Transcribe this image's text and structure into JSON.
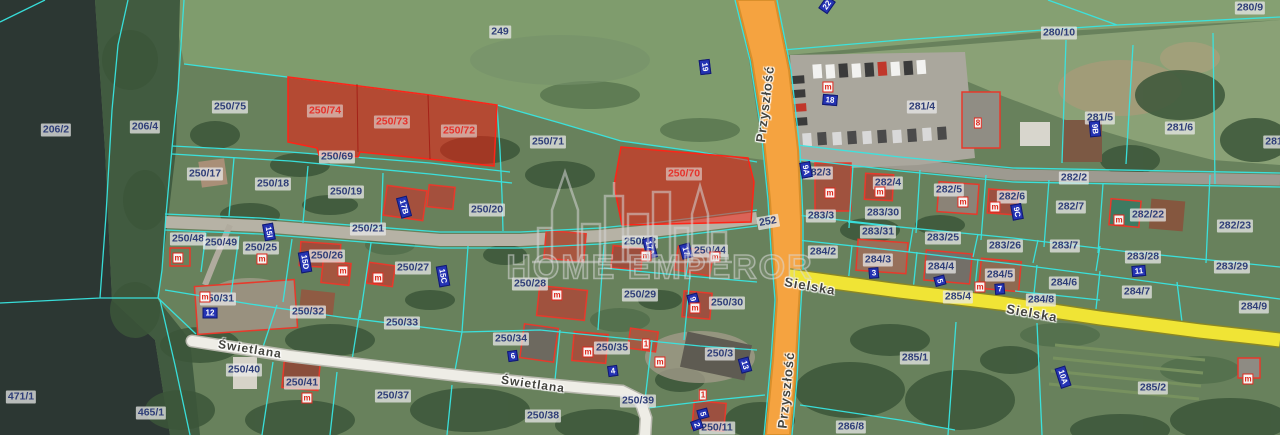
{
  "watermark": {
    "brand": "HOME EMPEROR"
  },
  "colors": {
    "boundary_cyan": "#38e6e2",
    "highlight_red": "#e5322b",
    "highlight_fill": "rgba(255,20,10,0.5)",
    "road_orange": "#f5a340",
    "road_yellow": "#f0e435",
    "road_white": "#eeede6",
    "label_navy": "#2f3e78",
    "badge_blue": "#2433b4",
    "marker_red": "#dd2418",
    "water": "#2c3733",
    "field_green": "#7f9c6d",
    "forest_green": "#415b40"
  },
  "map": {
    "parcel_labels": [
      {
        "t": "249",
        "x": 500,
        "y": 32
      },
      {
        "t": "206/2",
        "x": 56,
        "y": 130
      },
      {
        "t": "206/4",
        "x": 145,
        "y": 127
      },
      {
        "t": "250/75",
        "x": 230,
        "y": 107
      },
      {
        "t": "250/69",
        "x": 337,
        "y": 157
      },
      {
        "t": "250/71",
        "x": 548,
        "y": 142
      },
      {
        "t": "250/17",
        "x": 205,
        "y": 174
      },
      {
        "t": "250/18",
        "x": 273,
        "y": 184
      },
      {
        "t": "250/19",
        "x": 346,
        "y": 192
      },
      {
        "t": "250/20",
        "x": 487,
        "y": 210
      },
      {
        "t": "250/21",
        "x": 368,
        "y": 229
      },
      {
        "t": "250/48",
        "x": 188,
        "y": 239
      },
      {
        "t": "250/49",
        "x": 221,
        "y": 243
      },
      {
        "t": "250/25",
        "x": 261,
        "y": 248
      },
      {
        "t": "250/26",
        "x": 327,
        "y": 256
      },
      {
        "t": "250/27",
        "x": 413,
        "y": 268
      },
      {
        "t": "250/22",
        "x": 640,
        "y": 242
      },
      {
        "t": "250/44",
        "x": 710,
        "y": 251
      },
      {
        "t": "250/28",
        "x": 530,
        "y": 284
      },
      {
        "t": "250/29",
        "x": 640,
        "y": 295
      },
      {
        "t": "250/30",
        "x": 727,
        "y": 303
      },
      {
        "t": "250/31",
        "x": 218,
        "y": 299
      },
      {
        "t": "250/32",
        "x": 308,
        "y": 312
      },
      {
        "t": "250/33",
        "x": 402,
        "y": 323
      },
      {
        "t": "250/34",
        "x": 511,
        "y": 339
      },
      {
        "t": "250/35",
        "x": 612,
        "y": 348
      },
      {
        "t": "250/3",
        "x": 720,
        "y": 354
      },
      {
        "t": "250/40",
        "x": 244,
        "y": 370
      },
      {
        "t": "250/41",
        "x": 302,
        "y": 383
      },
      {
        "t": "250/37",
        "x": 393,
        "y": 396
      },
      {
        "t": "250/38",
        "x": 543,
        "y": 416
      },
      {
        "t": "250/39",
        "x": 638,
        "y": 401
      },
      {
        "t": "250/11",
        "x": 717,
        "y": 428
      },
      {
        "t": "471/1",
        "x": 21,
        "y": 397
      },
      {
        "t": "465/1",
        "x": 151,
        "y": 413
      },
      {
        "t": "280/9",
        "x": 1250,
        "y": 8
      },
      {
        "t": "280/10",
        "x": 1059,
        "y": 33
      },
      {
        "t": "281/4",
        "x": 922,
        "y": 107
      },
      {
        "t": "281/5",
        "x": 1100,
        "y": 118
      },
      {
        "t": "281/6",
        "x": 1180,
        "y": 128
      },
      {
        "t": "281",
        "x": 1274,
        "y": 142
      },
      {
        "t": "282/2",
        "x": 1074,
        "y": 178
      },
      {
        "t": "282/3",
        "x": 818,
        "y": 173
      },
      {
        "t": "282/4",
        "x": 888,
        "y": 183
      },
      {
        "t": "282/5",
        "x": 949,
        "y": 190
      },
      {
        "t": "282/6",
        "x": 1012,
        "y": 197
      },
      {
        "t": "282/7",
        "x": 1071,
        "y": 207
      },
      {
        "t": "282/22",
        "x": 1148,
        "y": 215
      },
      {
        "t": "282/23",
        "x": 1235,
        "y": 226
      },
      {
        "t": "283/3",
        "x": 821,
        "y": 216
      },
      {
        "t": "283/30",
        "x": 883,
        "y": 213
      },
      {
        "t": "283/31",
        "x": 878,
        "y": 232
      },
      {
        "t": "283/25",
        "x": 943,
        "y": 238
      },
      {
        "t": "283/26",
        "x": 1005,
        "y": 246
      },
      {
        "t": "283/7",
        "x": 1065,
        "y": 246
      },
      {
        "t": "283/28",
        "x": 1143,
        "y": 257
      },
      {
        "t": "283/29",
        "x": 1232,
        "y": 267
      },
      {
        "t": "284/2",
        "x": 823,
        "y": 252
      },
      {
        "t": "284/3",
        "x": 878,
        "y": 260
      },
      {
        "t": "284/4",
        "x": 941,
        "y": 267
      },
      {
        "t": "284/5",
        "x": 1000,
        "y": 275
      },
      {
        "t": "284/6",
        "x": 1064,
        "y": 283
      },
      {
        "t": "284/7",
        "x": 1137,
        "y": 292
      },
      {
        "t": "284/8",
        "x": 1041,
        "y": 300
      },
      {
        "t": "284/9",
        "x": 1254,
        "y": 307
      },
      {
        "t": "285/4",
        "x": 958,
        "y": 297
      },
      {
        "t": "285/1",
        "x": 915,
        "y": 358
      },
      {
        "t": "285/2",
        "x": 1153,
        "y": 388
      },
      {
        "t": "286/8",
        "x": 851,
        "y": 427
      },
      {
        "t": "252",
        "x": 768,
        "y": 222,
        "r": -10
      }
    ],
    "highlight_labels": [
      {
        "t": "250/74",
        "x": 325,
        "y": 111
      },
      {
        "t": "250/73",
        "x": 392,
        "y": 122
      },
      {
        "t": "250/72",
        "x": 459,
        "y": 131
      },
      {
        "t": "250/70",
        "x": 684,
        "y": 174
      }
    ],
    "street_names": [
      {
        "t": "Przyszłość",
        "x": 765,
        "y": 104,
        "r": -83
      },
      {
        "t": "Przyszłość",
        "x": 786,
        "y": 390,
        "r": -84
      },
      {
        "t": "Sielska",
        "x": 810,
        "y": 286,
        "r": 10
      },
      {
        "t": "Sielska",
        "x": 1032,
        "y": 313,
        "r": 10
      },
      {
        "t": "Świetlana",
        "x": 250,
        "y": 349,
        "r": 9,
        "fs": 12
      },
      {
        "t": "Świetlana",
        "x": 533,
        "y": 384,
        "r": 8,
        "fs": 12
      }
    ],
    "address_badges": [
      {
        "t": "22",
        "x": 827,
        "y": 5,
        "r": -55
      },
      {
        "t": "19",
        "x": 705,
        "y": 67,
        "r": 83
      },
      {
        "t": "18",
        "x": 830,
        "y": 100,
        "r": 5
      },
      {
        "t": "9B",
        "x": 1095,
        "y": 129,
        "r": 85
      },
      {
        "t": "9A",
        "x": 806,
        "y": 170,
        "r": 80
      },
      {
        "t": "9C",
        "x": 1017,
        "y": 212,
        "r": 80
      },
      {
        "t": "17B",
        "x": 404,
        "y": 207,
        "r": 75
      },
      {
        "t": "15I",
        "x": 269,
        "y": 232,
        "r": 80
      },
      {
        "t": "15D",
        "x": 305,
        "y": 262,
        "r": 80
      },
      {
        "t": "15C",
        "x": 443,
        "y": 276,
        "r": 80
      },
      {
        "t": "17A",
        "x": 650,
        "y": 248,
        "r": 75
      },
      {
        "t": "17",
        "x": 686,
        "y": 251,
        "r": 75
      },
      {
        "t": "12",
        "x": 210,
        "y": 313,
        "r": 0
      },
      {
        "t": "9",
        "x": 693,
        "y": 299,
        "r": 75
      },
      {
        "t": "11",
        "x": 1139,
        "y": 271,
        "r": -5
      },
      {
        "t": "3",
        "x": 874,
        "y": 273,
        "r": -5
      },
      {
        "t": "5",
        "x": 940,
        "y": 281,
        "r": 75
      },
      {
        "t": "7",
        "x": 1000,
        "y": 289,
        "r": -5
      },
      {
        "t": "6",
        "x": 513,
        "y": 356,
        "r": -8
      },
      {
        "t": "4",
        "x": 613,
        "y": 371,
        "r": -8
      },
      {
        "t": "13",
        "x": 745,
        "y": 365,
        "r": 75
      },
      {
        "t": "10A",
        "x": 1063,
        "y": 377,
        "r": 72
      },
      {
        "t": "5",
        "x": 703,
        "y": 414,
        "r": 75
      },
      {
        "t": "2",
        "x": 697,
        "y": 425,
        "r": 70
      }
    ],
    "building_markers": [
      {
        "t": "m",
        "x": 178,
        "y": 258
      },
      {
        "t": "m",
        "x": 262,
        "y": 259
      },
      {
        "t": "m",
        "x": 343,
        "y": 271
      },
      {
        "t": "m",
        "x": 378,
        "y": 278
      },
      {
        "t": "m",
        "x": 205,
        "y": 297
      },
      {
        "t": "m",
        "x": 307,
        "y": 398
      },
      {
        "t": "m",
        "x": 557,
        "y": 295
      },
      {
        "t": "m",
        "x": 695,
        "y": 308
      },
      {
        "t": "m",
        "x": 588,
        "y": 352
      },
      {
        "t": "m",
        "x": 830,
        "y": 193
      },
      {
        "t": "m",
        "x": 880,
        "y": 192
      },
      {
        "t": "m",
        "x": 963,
        "y": 202
      },
      {
        "t": "m",
        "x": 995,
        "y": 207
      },
      {
        "t": "m",
        "x": 1119,
        "y": 220
      },
      {
        "t": "m",
        "x": 1248,
        "y": 379
      },
      {
        "t": "m",
        "x": 646,
        "y": 256
      },
      {
        "t": "m",
        "x": 715,
        "y": 257
      },
      {
        "t": "m",
        "x": 828,
        "y": 87
      },
      {
        "t": "m",
        "x": 980,
        "y": 287
      },
      {
        "t": "m",
        "x": 660,
        "y": 362
      },
      {
        "t": "1",
        "x": 646,
        "y": 344
      },
      {
        "t": "1",
        "x": 703,
        "y": 395
      },
      {
        "t": "8",
        "x": 978,
        "y": 123
      }
    ]
  }
}
